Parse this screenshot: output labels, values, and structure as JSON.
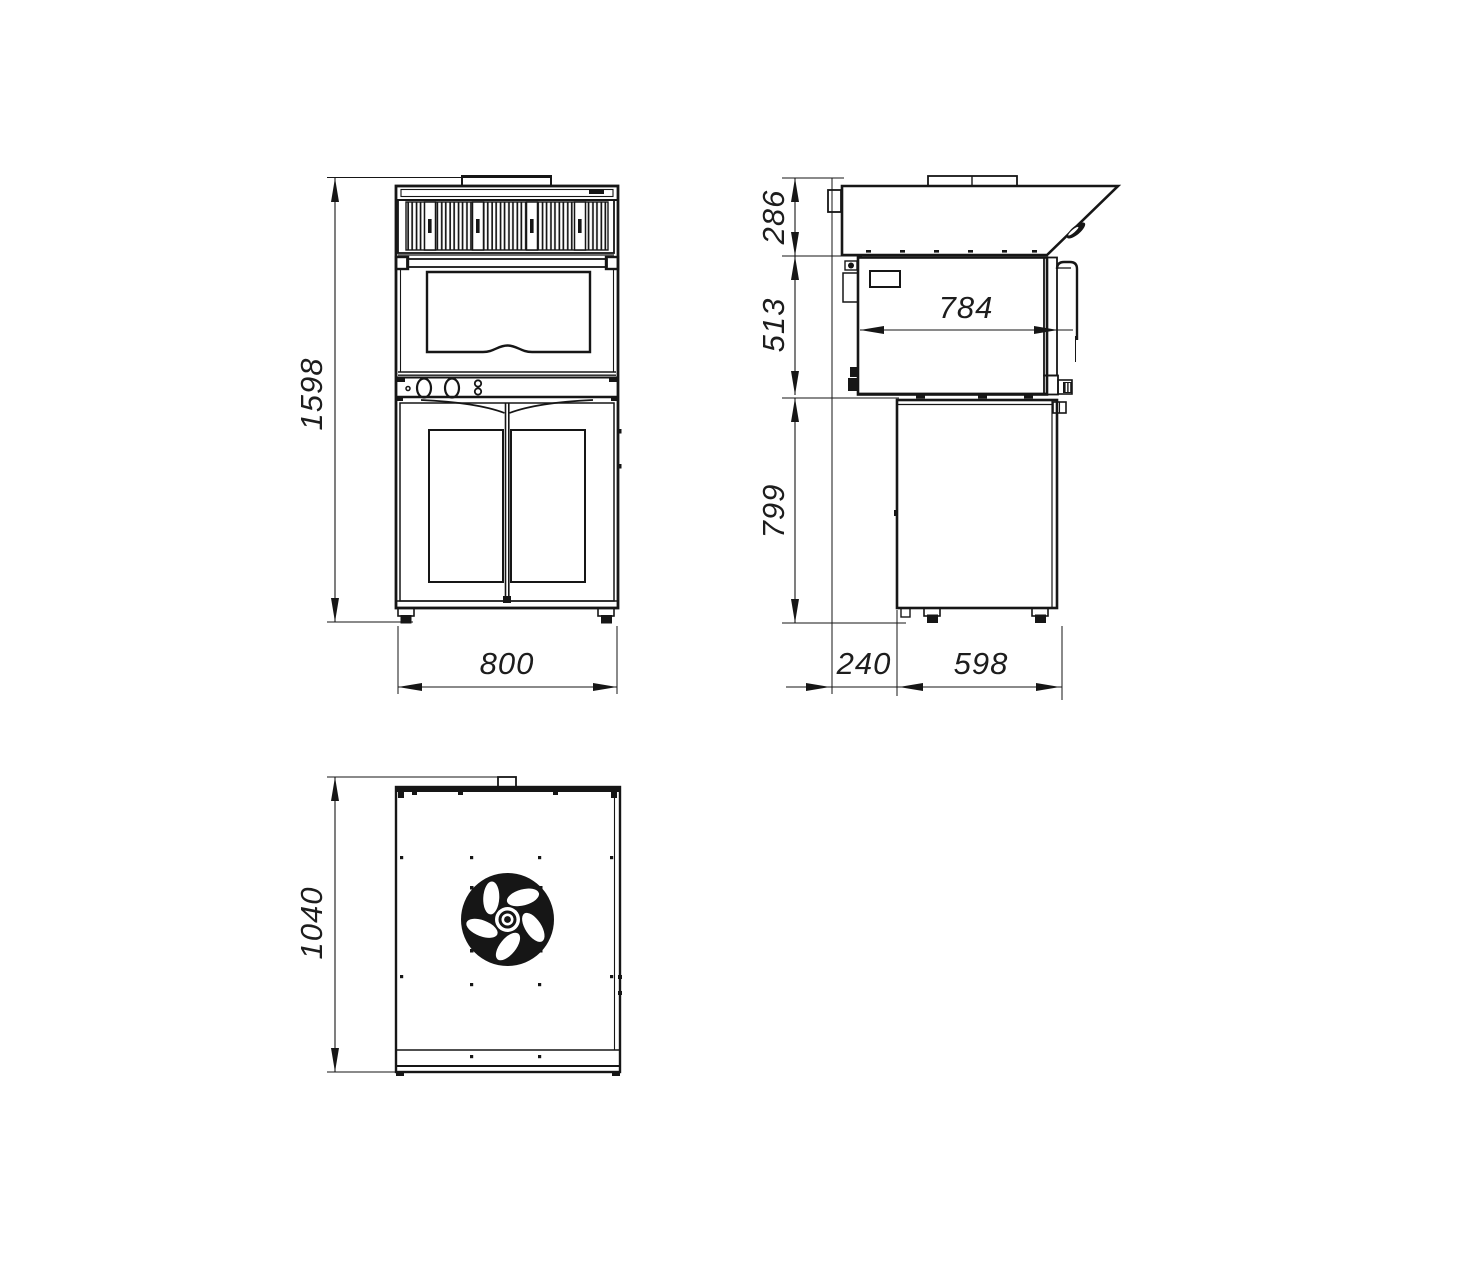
{
  "drawing": {
    "type": "technical-dimension-drawing",
    "colors": {
      "line": "#161616",
      "background": "#ffffff",
      "text": "#1d1d1d"
    },
    "dimensions": {
      "front_height": "1598",
      "front_width": "800",
      "side_hood_height": "286",
      "side_oven_height": "513",
      "side_base_height": "799",
      "side_oven_depth": "784",
      "side_back_offset": "240",
      "side_base_depth": "598",
      "top_depth": "1040"
    }
  }
}
